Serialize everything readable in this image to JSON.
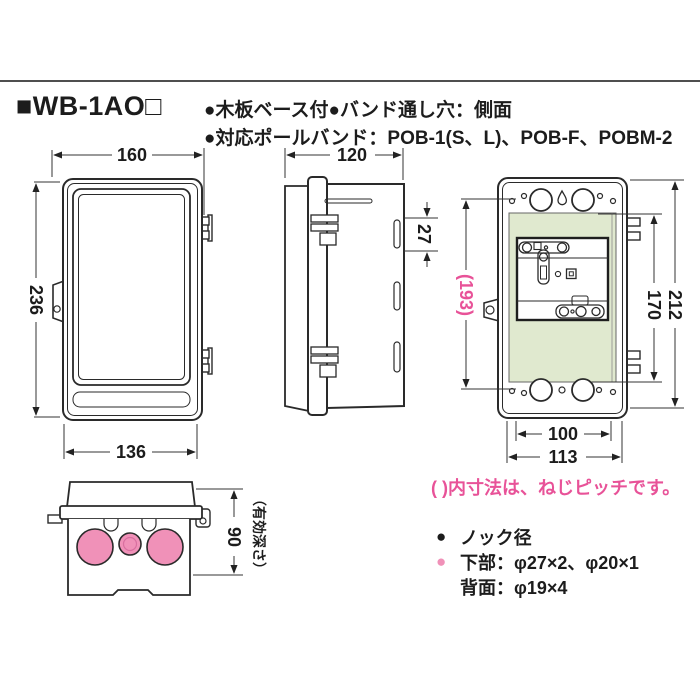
{
  "header": {
    "model": "■WB-1AO□",
    "features_line1": "●木板ベース付●バンド通し穴：側面",
    "features_line2": "●対応ポールバンド：POB-1(S、L)、POB-F、POBM-2"
  },
  "dimensions": {
    "front_width": "160",
    "front_height": "236",
    "front_inner_width": "136",
    "side_depth": "120",
    "band_slot_pitch": "27",
    "rear_screw_pitch": "(193)",
    "rear_base_height": "170",
    "rear_height": "212",
    "rear_knock_pitch": "100",
    "rear_width": "113",
    "effective_depth": "90",
    "effective_depth_note": "（有効深さ）"
  },
  "notes": {
    "pitch_note": "( )内寸法は、ねじピッチです。"
  },
  "knock_list": {
    "bullet": "●",
    "title": "ノック径",
    "row_bottom": "下部：φ27×2、φ20×1",
    "row_back": "背面：φ19×4"
  },
  "colors": {
    "accent_pink": "#e85298",
    "knockout_pink": "#f091b8",
    "base_green": "#e0e9cf",
    "line": "#2a2a2a",
    "rule": "#4f4f4f"
  }
}
